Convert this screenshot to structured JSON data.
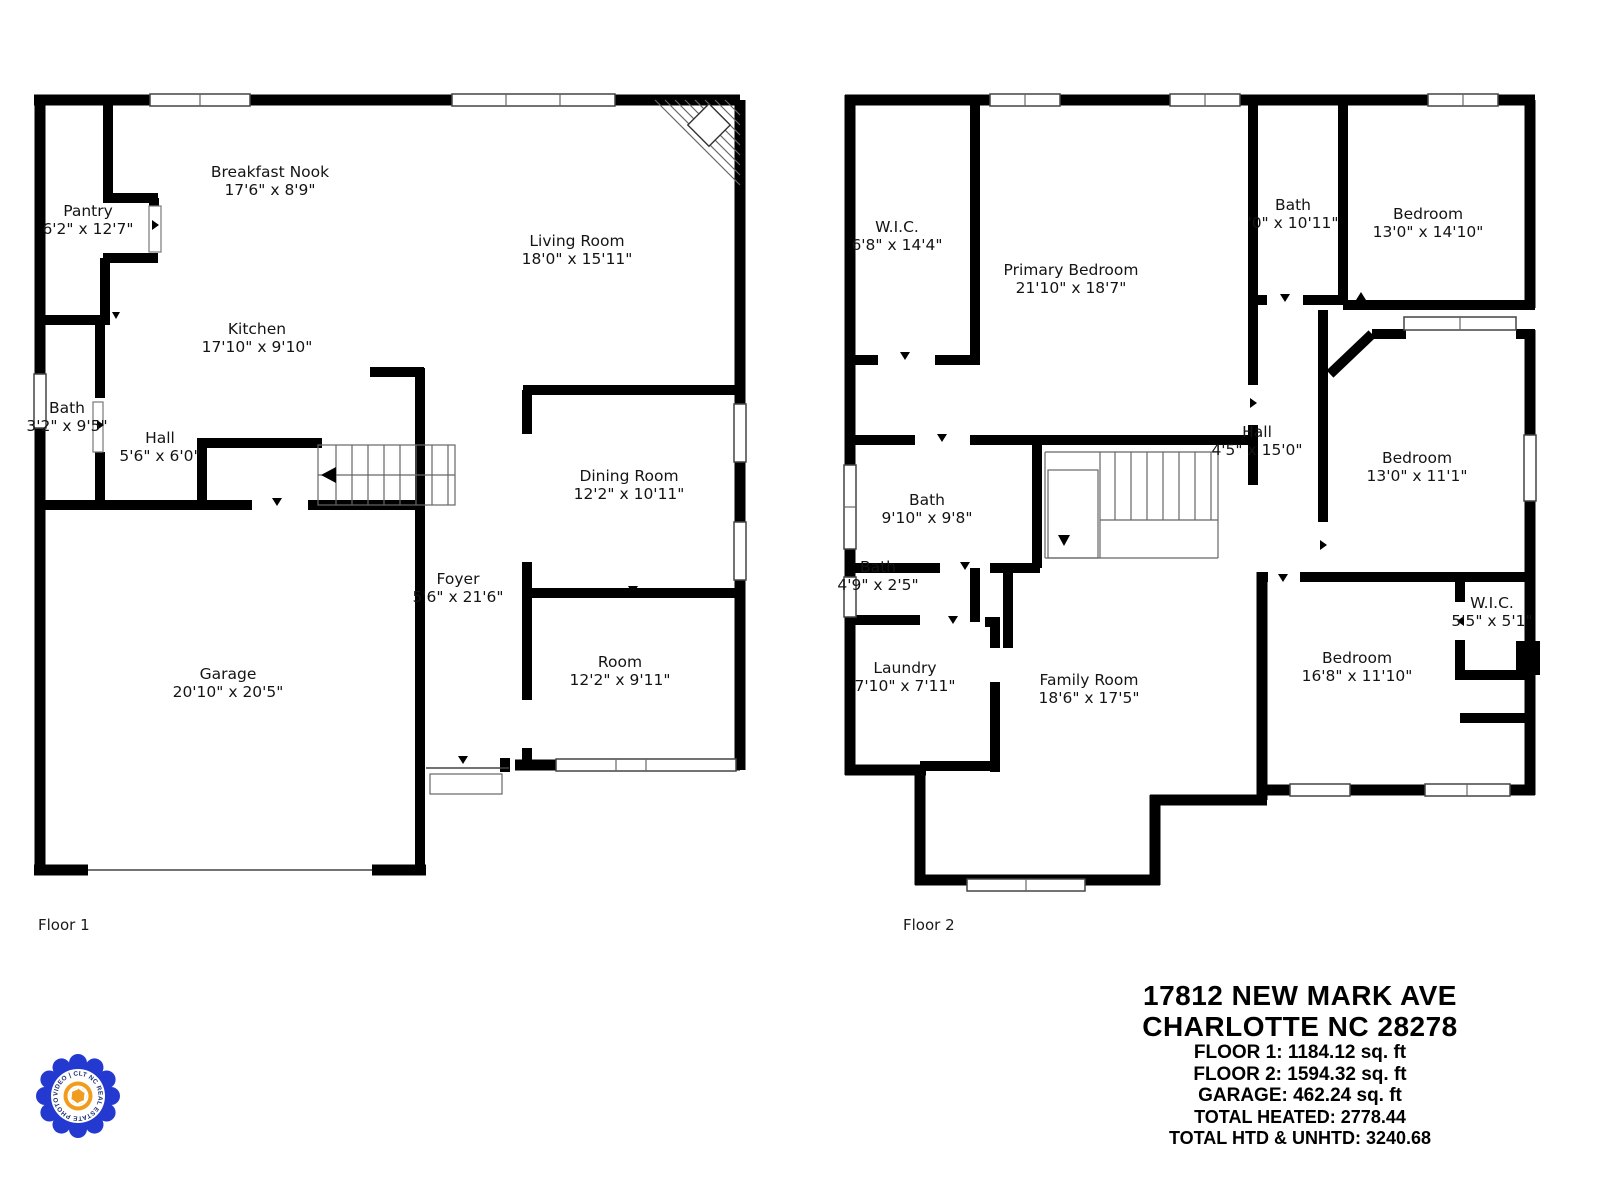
{
  "floor1": {
    "label": "Floor 1",
    "rooms": [
      {
        "name": "Pantry",
        "dims": "6'2\" x 12'7\""
      },
      {
        "name": "Breakfast Nook",
        "dims": "17'6\" x 8'9\""
      },
      {
        "name": "Living Room",
        "dims": "18'0\" x 15'11\""
      },
      {
        "name": "Kitchen",
        "dims": "17'10\" x 9'10\""
      },
      {
        "name": "Bath",
        "dims": "3'2\" x 9'5\""
      },
      {
        "name": "Hall",
        "dims": "5'6\" x 6'0\""
      },
      {
        "name": "Dining Room",
        "dims": "12'2\" x 10'11\""
      },
      {
        "name": "Foyer",
        "dims": "5'6\" x 21'6\""
      },
      {
        "name": "Room",
        "dims": "12'2\" x 9'11\""
      },
      {
        "name": "Garage",
        "dims": "20'10\" x 20'5\""
      }
    ]
  },
  "floor2": {
    "label": "Floor 2",
    "rooms": [
      {
        "name": "W.I.C.",
        "dims": "6'8\" x 14'4\""
      },
      {
        "name": "Primary Bedroom",
        "dims": "21'10\" x 18'7\""
      },
      {
        "name": "Bath",
        "dims": "'0\" x 10'11\""
      },
      {
        "name": "Bedroom",
        "dims": "13'0\" x 14'10\""
      },
      {
        "name": "Hall",
        "dims": "4'5\" x 15'0\""
      },
      {
        "name": "Bath",
        "dims": "9'10\" x 9'8\""
      },
      {
        "name": "Bath",
        "dims": "4'9\" x 2'5\""
      },
      {
        "name": "Bedroom",
        "dims": "13'0\" x 11'1\""
      },
      {
        "name": "Laundry",
        "dims": "7'10\" x 7'11\""
      },
      {
        "name": "Family Room",
        "dims": "18'6\" x 17'5\""
      },
      {
        "name": "Bedroom",
        "dims": "16'8\" x 11'10\""
      },
      {
        "name": "W.I.C.",
        "dims": "5'5\" x 5'1\""
      }
    ]
  },
  "info": {
    "address_line1": "17812 NEW MARK AVE",
    "address_line2": "CHARLOTTE NC 28278",
    "lines": [
      "FLOOR 1:  1184.12 sq. ft",
      "FLOOR 2:  1594.32 sq. ft",
      "GARAGE:  462.24 sq. ft",
      "TOTAL HEATED: 2778.44",
      "TOTAL HTD & UNHTD: 3240.68"
    ]
  },
  "logo": {
    "ring_text": "VIDEO | CLT NC REAL ESTATE PHOTO |",
    "ring_color": "#2439cf",
    "text_color": "#1b2f73",
    "center_color": "#f09c1e"
  },
  "colors": {
    "wall": "#000000",
    "background": "#ffffff"
  }
}
